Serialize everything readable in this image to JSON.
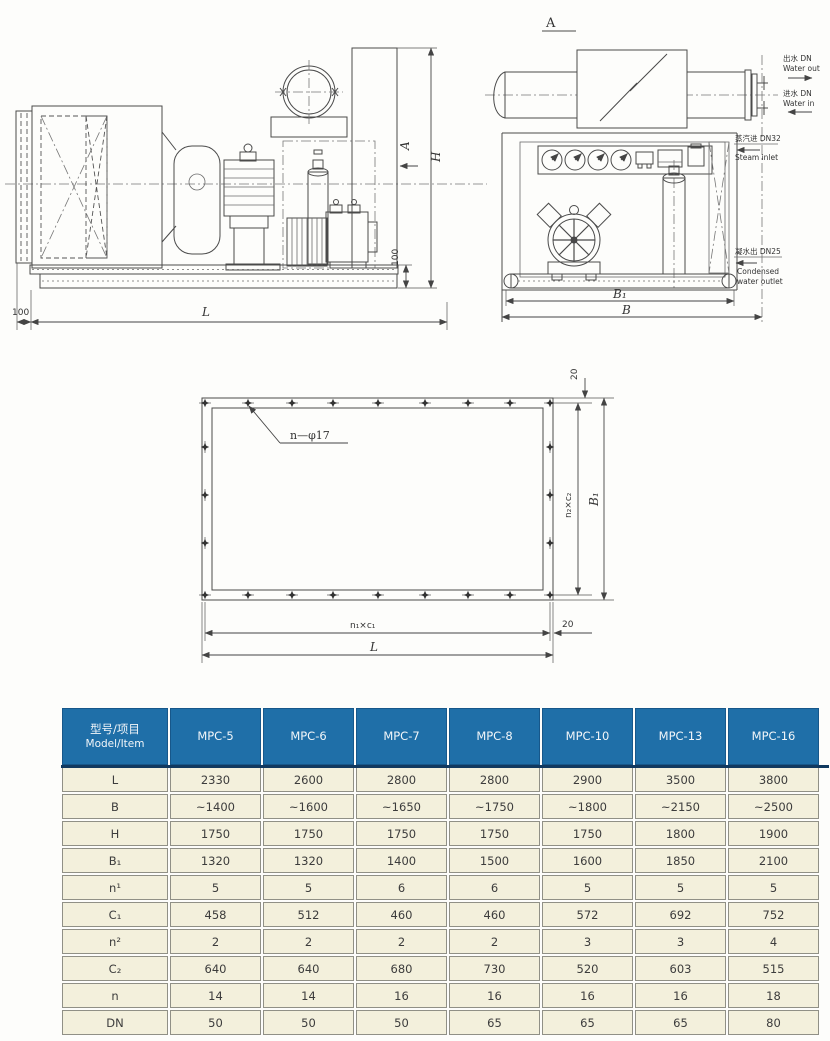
{
  "drawings": {
    "side_view": {
      "dim_L": "L",
      "dim_H": "H",
      "base_height": "100",
      "left_offset": "100",
      "section_label": "A"
    },
    "end_view": {
      "view_label": "A",
      "dim_B1": "B₁",
      "dim_B": "B"
    },
    "flange_view": {
      "hole_label": "n—φ17",
      "top_margin": "20",
      "dim_n2c2": "n₂×c₂",
      "dim_B1": "B₁",
      "bottom_margin": "20",
      "dim_n1c1": "n₁×c₁",
      "dim_L": "L"
    },
    "annotations": {
      "water_out_zh": "出水 DN",
      "water_out_en": "Water out",
      "water_in_zh": "进水 DN",
      "water_in_en": "Water in",
      "steam_in_zh": "蒸汽进 DN32",
      "steam_in_en": "Steam inlet",
      "condensed_zh": "凝水出 DN25",
      "condensed_en_1": "Condensed",
      "condensed_en_2": "water outlet"
    }
  },
  "table": {
    "header_model_item_zh": "型号/项目",
    "header_model_item_en": "Model/Item",
    "models": [
      "MPC-5",
      "MPC-6",
      "MPC-7",
      "MPC-8",
      "MPC-10",
      "MPC-13",
      "MPC-16"
    ],
    "rows": [
      {
        "label": "L",
        "values": [
          "2330",
          "2600",
          "2800",
          "2800",
          "2900",
          "3500",
          "3800"
        ]
      },
      {
        "label": "B",
        "values": [
          "~1400",
          "~1600",
          "~1650",
          "~1750",
          "~1800",
          "~2150",
          "~2500"
        ]
      },
      {
        "label": "H",
        "values": [
          "1750",
          "1750",
          "1750",
          "1750",
          "1750",
          "1800",
          "1900"
        ]
      },
      {
        "label": "B₁",
        "values": [
          "1320",
          "1320",
          "1400",
          "1500",
          "1600",
          "1850",
          "2100"
        ]
      },
      {
        "label": "n¹",
        "values": [
          "5",
          "5",
          "6",
          "6",
          "5",
          "5",
          "5"
        ]
      },
      {
        "label": "C₁",
        "values": [
          "458",
          "512",
          "460",
          "460",
          "572",
          "692",
          "752"
        ]
      },
      {
        "label": "n²",
        "values": [
          "2",
          "2",
          "2",
          "2",
          "3",
          "3",
          "4"
        ]
      },
      {
        "label": "C₂",
        "values": [
          "640",
          "640",
          "680",
          "730",
          "520",
          "603",
          "515"
        ]
      },
      {
        "label": "n",
        "values": [
          "14",
          "14",
          "16",
          "16",
          "16",
          "16",
          "18"
        ]
      },
      {
        "label": "DN",
        "values": [
          "50",
          "50",
          "50",
          "65",
          "65",
          "65",
          "80"
        ]
      }
    ]
  },
  "colors": {
    "header_blue": "#1f6fa8",
    "cell_cream": "#f3f0dc",
    "header_rule": "#11395f"
  }
}
